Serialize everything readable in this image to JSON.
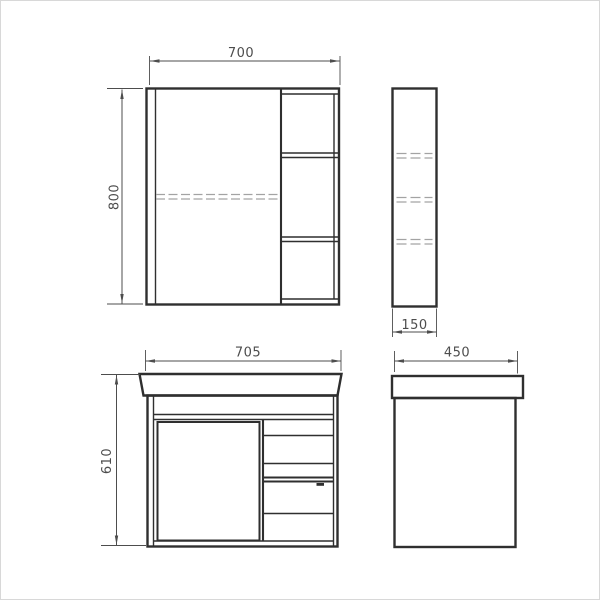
{
  "views": {
    "mirror_cabinet_front": {
      "width_label": "700",
      "height_label": "800"
    },
    "mirror_cabinet_side": {
      "depth_label": "150"
    },
    "vanity_front": {
      "width_label": "705",
      "height_label": "610"
    },
    "vanity_side": {
      "depth_label": "450"
    }
  },
  "colors": {
    "outline": "#2f2f2f",
    "dimension_line": "#4d4d4d",
    "dimension_text": "#4d4d4d",
    "hidden_line": "#a3a3a3",
    "background": "#ffffff",
    "frame_border": "#d8d8d8"
  }
}
